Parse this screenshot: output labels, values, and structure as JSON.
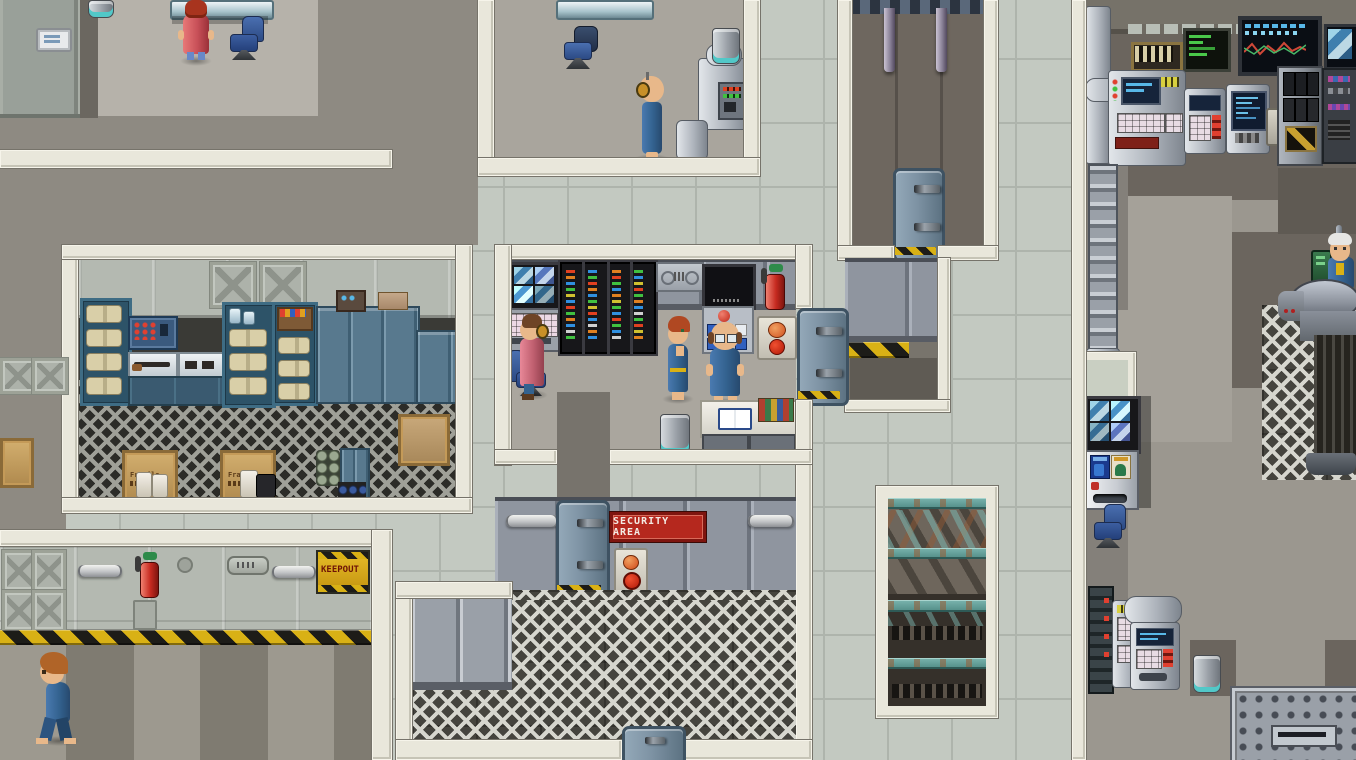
{
  "scene": {
    "description": "Top-down pixel-art sci-fi vault facility map",
    "resolution": "1356x760"
  },
  "signs": {
    "security_area": "SECURITY AREA",
    "keepout": "KEEPOUT",
    "crate_stencil": "Fragile"
  },
  "colors": {
    "corridor_tile": "#c3c9c1",
    "white_wall": "#e9e7db",
    "hazard_yellow": "#d9b115",
    "security_sign_red": "#b5281e",
    "keepout_sign_yellow": "#d9a912",
    "locker_blue": "#58798e",
    "vault_suit_blue": "#33628f",
    "rust_truss_teal": "#5b9a96"
  },
  "characters": [
    {
      "id": "receptionist-red-robe",
      "outfit": "red robe, red hair",
      "location": "top-left office, facing desk"
    },
    {
      "id": "technician-headset",
      "outfit": "blue jumpsuit, headset",
      "location": "top-middle room, facing machinery"
    },
    {
      "id": "operator-pink-coat",
      "outfit": "pink coat, headset",
      "location": "monitoring room console, seated"
    },
    {
      "id": "redhead-woman-vault-suit",
      "outfit": "blue vault suit",
      "location": "monitoring room"
    },
    {
      "id": "overseer-glasses",
      "outfit": "blue vault suit, glasses",
      "location": "monitoring room console"
    },
    {
      "id": "elder-in-scanner-pod",
      "outfit": "blue vault suit, white hair",
      "location": "right-wing scanner pod"
    },
    {
      "id": "woman-walking-blue-suit",
      "outfit": "blue vault suit, auburn hair",
      "location": "bottom-left corridor"
    }
  ],
  "objects": [
    "security-camera-monitor",
    "server-racks",
    "wall-monitor",
    "control-panel",
    "fire-extinguisher",
    "supply-shelves",
    "weapon-rack",
    "blue-lockers",
    "fragile-crates",
    "canned-goods-stack",
    "office-chairs",
    "glass-desks",
    "trash-cans",
    "open-book-desk",
    "rusty-truss-pit",
    "vending-machine",
    "cctv-quad-monitor",
    "terminal-consoles",
    "waveform-dashboard-monitor",
    "circuit-breaker-cabinet",
    "scanner-pod",
    "floor-grate-platform",
    "metal-doors",
    "hanging-pipes"
  ]
}
